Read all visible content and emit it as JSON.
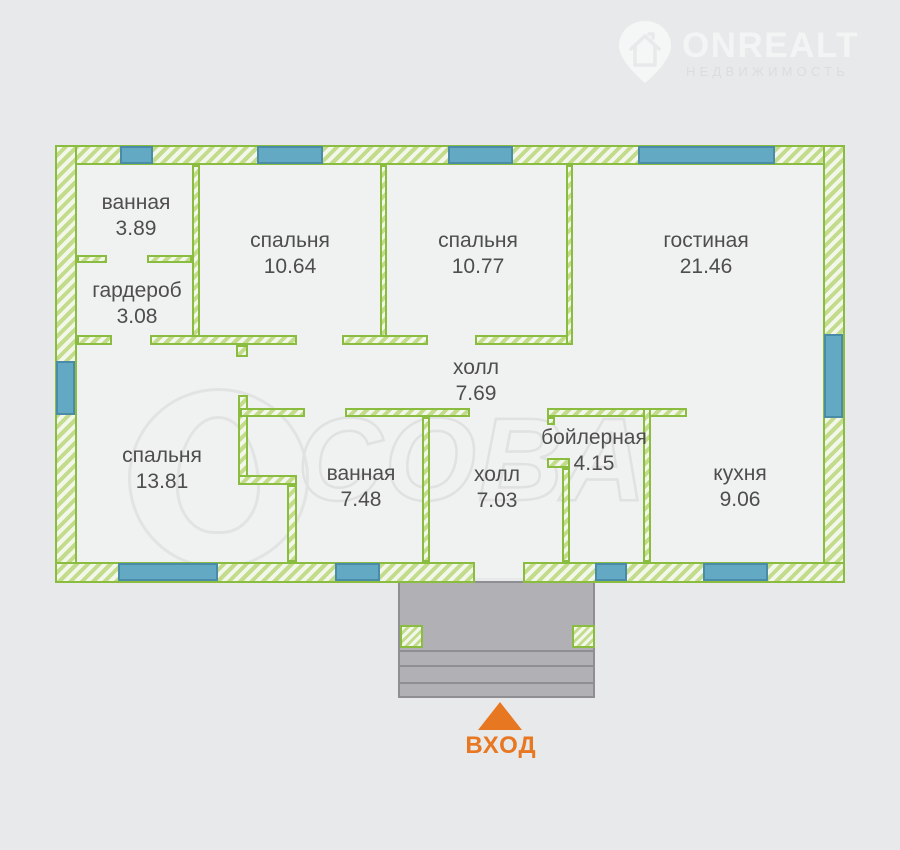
{
  "watermark_logo": {
    "brand": "ONREALT",
    "subtitle": "НЕДВИЖИМОСТЬ"
  },
  "watermark_center": {
    "text": "СОВА"
  },
  "rooms": [
    {
      "id": "bathroom-top",
      "name": "ванная",
      "area": "3.89"
    },
    {
      "id": "wardrobe",
      "name": "гардероб",
      "area": "3.08"
    },
    {
      "id": "bedroom-1",
      "name": "спальня",
      "area": "10.64"
    },
    {
      "id": "bedroom-2",
      "name": "спальня",
      "area": "10.77"
    },
    {
      "id": "living-room",
      "name": "гостиная",
      "area": "21.46"
    },
    {
      "id": "hall-main",
      "name": "холл",
      "area": "7.69"
    },
    {
      "id": "bedroom-3",
      "name": "спальня",
      "area": "13.81"
    },
    {
      "id": "bathroom-2",
      "name": "ванная",
      "area": "7.48"
    },
    {
      "id": "hall-2",
      "name": "холл",
      "area": "7.03"
    },
    {
      "id": "boiler-room",
      "name": "бойлерная",
      "area": "4.15"
    },
    {
      "id": "kitchen",
      "name": "кухня",
      "area": "9.06"
    }
  ],
  "entrance": {
    "label": "ВХОД"
  },
  "colors": {
    "wall_green": "#8abd3f",
    "wall_hatch": "#c2dc8c",
    "window_blue": "#63a9c3",
    "window_border": "#4a8ba7",
    "porch_gray": "#b1b1b5",
    "entrance_orange": "#e87722",
    "label_text": "#4e4e4e",
    "background": "#e8e9ea",
    "floor": "#f0f1f1"
  }
}
